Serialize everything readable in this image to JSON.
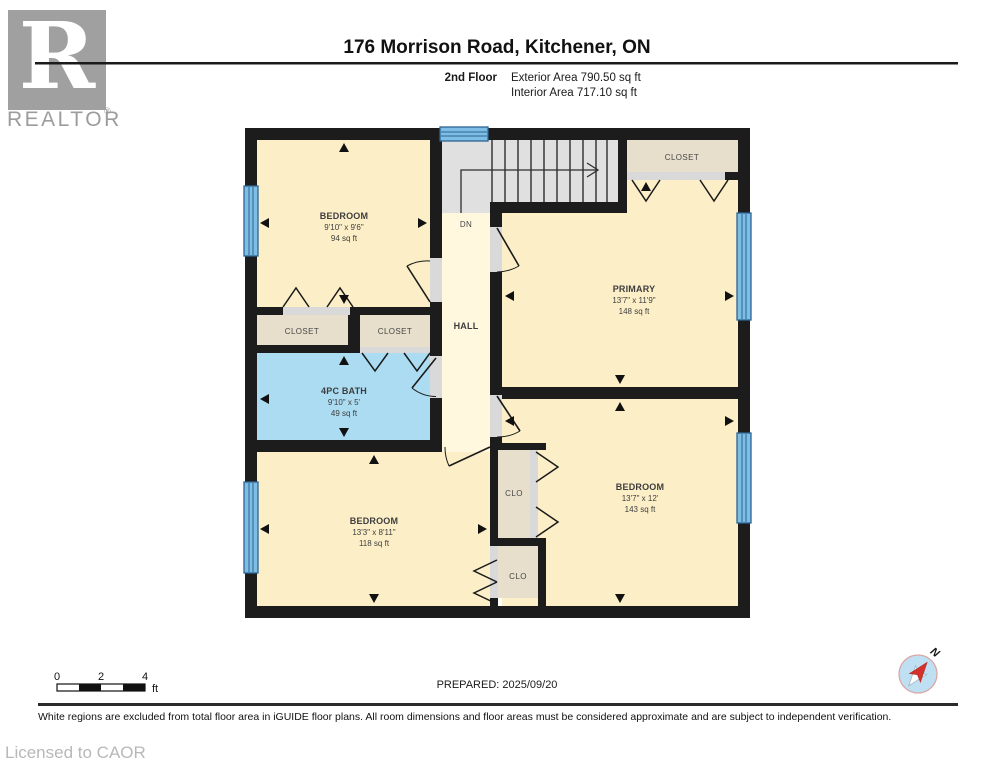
{
  "header": {
    "title": "176 Morrison Road, Kitchener, ON",
    "floor_label": "2nd Floor",
    "exterior_area": "Exterior Area 790.50 sq ft",
    "interior_area": "Interior Area 717.10 sq ft",
    "logo_letter": "R",
    "logo_text": "REALTOR",
    "logo_registered": "®"
  },
  "plan": {
    "rooms": {
      "bedroom_tl": {
        "name": "BEDROOM",
        "dims": "9'10\" x 9'6\"",
        "area": "94 sq ft"
      },
      "primary": {
        "name": "PRIMARY",
        "dims": "13'7\" x 11'9\"",
        "area": "148 sq ft"
      },
      "bath": {
        "name": "4PC BATH",
        "dims": "9'10\" x 5'",
        "area": "49 sq ft"
      },
      "bedroom_bl": {
        "name": "BEDROOM",
        "dims": "13'3\" x 8'11\"",
        "area": "118 sq ft"
      },
      "bedroom_br": {
        "name": "BEDROOM",
        "dims": "13'7\" x 12'",
        "area": "143 sq ft"
      },
      "hall": {
        "name": "HALL"
      },
      "closet_left": {
        "name": "CLOSET"
      },
      "closet_mid": {
        "name": "CLOSET"
      },
      "closet_tr": {
        "name": "CLOSET"
      },
      "clo_top": {
        "name": "CLO"
      },
      "clo_bottom": {
        "name": "CLO"
      }
    },
    "stairs_label": "DN",
    "compass_label": "N"
  },
  "scale_bar": {
    "tick0": "0",
    "tick2": "2",
    "tick4": "4",
    "unit": "ft"
  },
  "prepared": "PREPARED: 2025/09/20",
  "footer": {
    "disclaimer": "White regions are excluded from total floor area in iGUIDE floor plans. All room dimensions and floor areas must be considered approximate and are subject to independent verification.",
    "license": "Licensed to CAOR"
  },
  "colors": {
    "room_fill": "#FCEFC8",
    "hall_fill": "#FFF7DE",
    "bath_fill": "#ACDCF2",
    "closet_fill": "#E7DECC",
    "stairs_fill": "#E0E0E0",
    "wall": "#1C1C1C",
    "window_blue": "#7FBEE4",
    "window_frame": "#2C6493",
    "compass_red": "#D3312C",
    "logo_gray": "#A0A0A0"
  }
}
